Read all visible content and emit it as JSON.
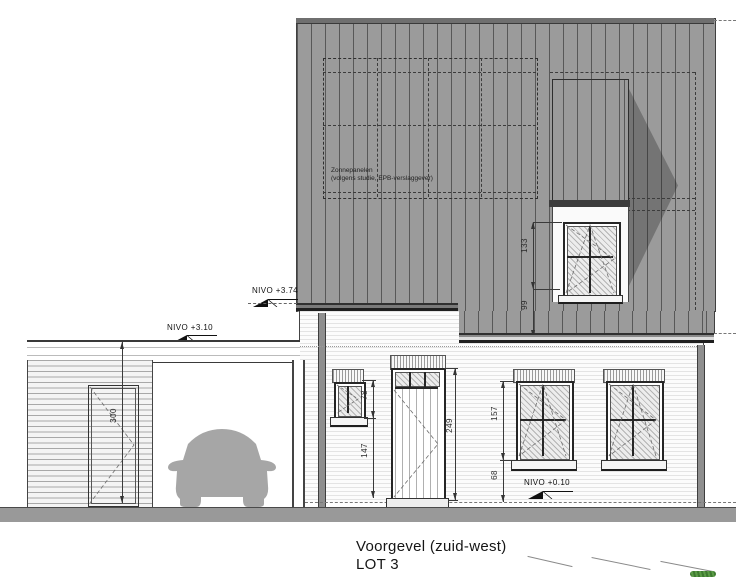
{
  "drawing": {
    "title": "Voorgevel  (zuid-west)",
    "lot": "LOT 3"
  },
  "roof": {
    "solar_note_line1": "Zonnepanelen",
    "solar_note_line2": "(volgens studie, EPB-verslaggever)"
  },
  "levels": {
    "eave_upper": "NIVO  +3.74",
    "carport_roof": "NIVO  +3.10",
    "ground": "NIVO  +0.10"
  },
  "dimensions": {
    "dormer_window_height": "133",
    "dormer_parapet": "99",
    "small_window_height": "78",
    "small_window_sill": "147",
    "door_height": "249",
    "window_height": "157",
    "window_sill": "68",
    "carport_height": "300"
  },
  "colors": {
    "cladding_gray": "#9b9b9b",
    "seam_line": "#585858",
    "shadow": "rgba(35,35,35,0.32)",
    "ground_slab": "#999999",
    "car_silhouette": "#a6a6a6",
    "vegetation_green": "#4c8f3a",
    "line_dark": "#3a3a3a"
  }
}
